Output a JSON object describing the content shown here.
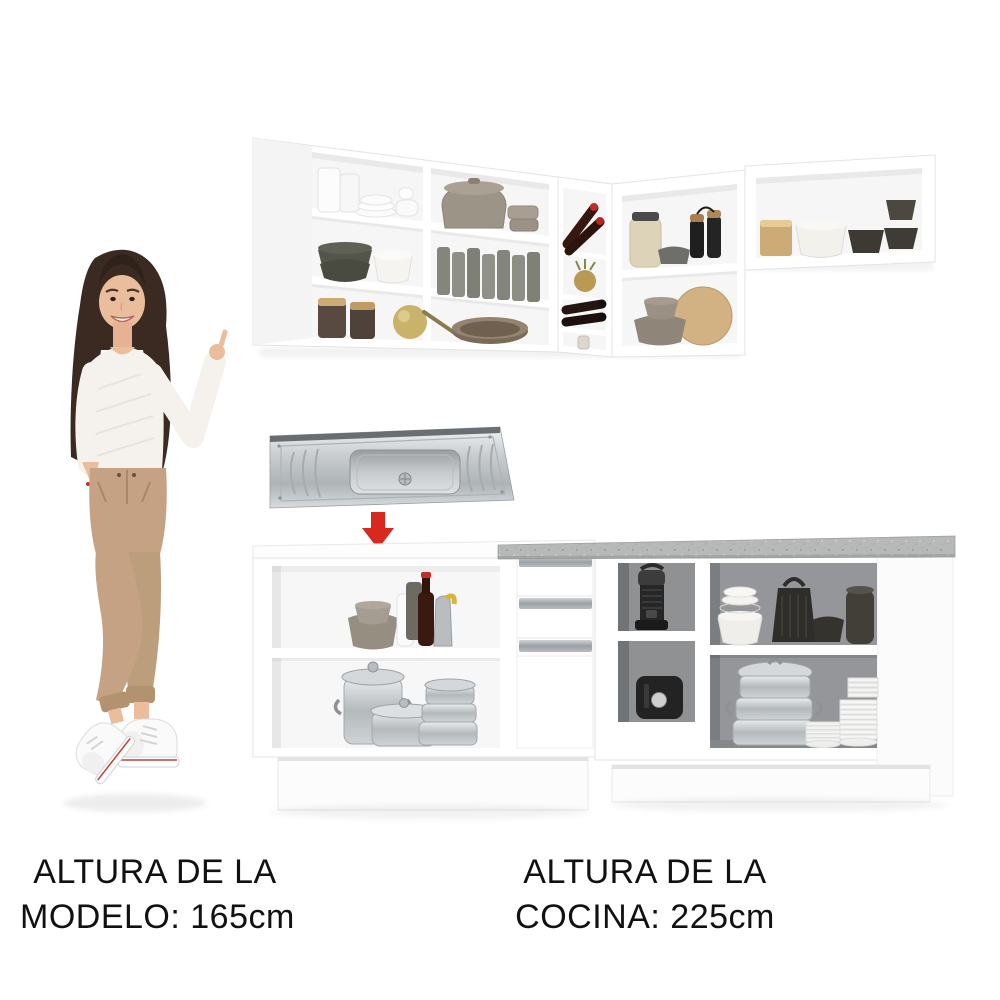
{
  "image": {
    "kind": "e-commerce product photo",
    "description": "White L-shaped modular kitchen (wall cabinets and base cabinets with open shelves full of dishware), a stainless steel sink with a red arrow showing where it installs, and a female model included for height scale."
  },
  "captions": {
    "model_height": {
      "line1": "ALTURA DE LA",
      "line2": "MODELO: 165cm"
    },
    "kitchen_height": {
      "line1": "ALTURA DE LA",
      "line2": "COCINA: 225cm"
    }
  },
  "colors": {
    "background": "#ffffff",
    "cabinet_white": "#ffffff",
    "frame_line": "#e3e3e3",
    "interior_light": "#f6f6f6",
    "interior_dark": "#8f9193",
    "countertop_gray": "#b6b9b7",
    "countertop_speck": "#9a9d9a",
    "arrow_red": "#d8291f",
    "steel_light": "#eef0f1",
    "steel_mid": "#c3c7ca",
    "steel_dark": "#a6abae",
    "text_black": "#111111",
    "taupe": "#9d9488",
    "dark_ceramic": "#45443c",
    "wood": "#cdab77",
    "bottle_brown": "#3a2013",
    "skin": "#eabd9d",
    "hair_brown": "#3a2a21",
    "sweater_white": "#f5f2ed",
    "pants_tan": "#c4a283",
    "sneaker_white": "#fafafa"
  },
  "scene": {
    "wall_cabinets": {
      "left_cabinet_items": [
        "white cups and stacked plates",
        "taupe lidded pot and round boxes",
        "stacked dark bowls and white bowls",
        "gray drinking glasses",
        "brown storage jars with wood lids",
        "gold ladle",
        "brown pan"
      ],
      "wine_rack_items": [
        "wine bottles with red caps",
        "small golden plant",
        "lying wine bottles",
        "small bottle"
      ],
      "corner_cabinet_items": [
        "cream jar with dark lid",
        "gray bowl",
        "black pepper mills",
        "taupe bowls",
        "round wooden cutting board"
      ],
      "right_cabinet_items": [
        "wooden box",
        "white scalloped bowls",
        "dark square bowls",
        "stacked dark bowls"
      ]
    },
    "sink": "stainless steel drop-in sink with center basin and double drainboard",
    "arrow": "red arrow pointing from sink down to base cabinet",
    "model": "smiling woman with long dark hair, white knit sweater, tan trousers and white sneakers, pointing at the kitchen",
    "base_cabinets": {
      "left_section_items": [
        "stacked taupe bowls",
        "white bottle",
        "wine bottle with red cap",
        "gray grinder",
        "oil can",
        "lidded aluminum pot",
        "aluminum casserole",
        "stacked steamer pots"
      ],
      "right_section_items": [
        "espresso machine",
        "black countertop appliance",
        "stacked white bowls",
        "black cone grater",
        "dark bowls and kettle",
        "three-tier steamer pot",
        "stacks of white plates"
      ],
      "features": [
        "three drawers with gray bar handles",
        "white door panel",
        "gray speckled countertop",
        "white plinth"
      ]
    }
  }
}
